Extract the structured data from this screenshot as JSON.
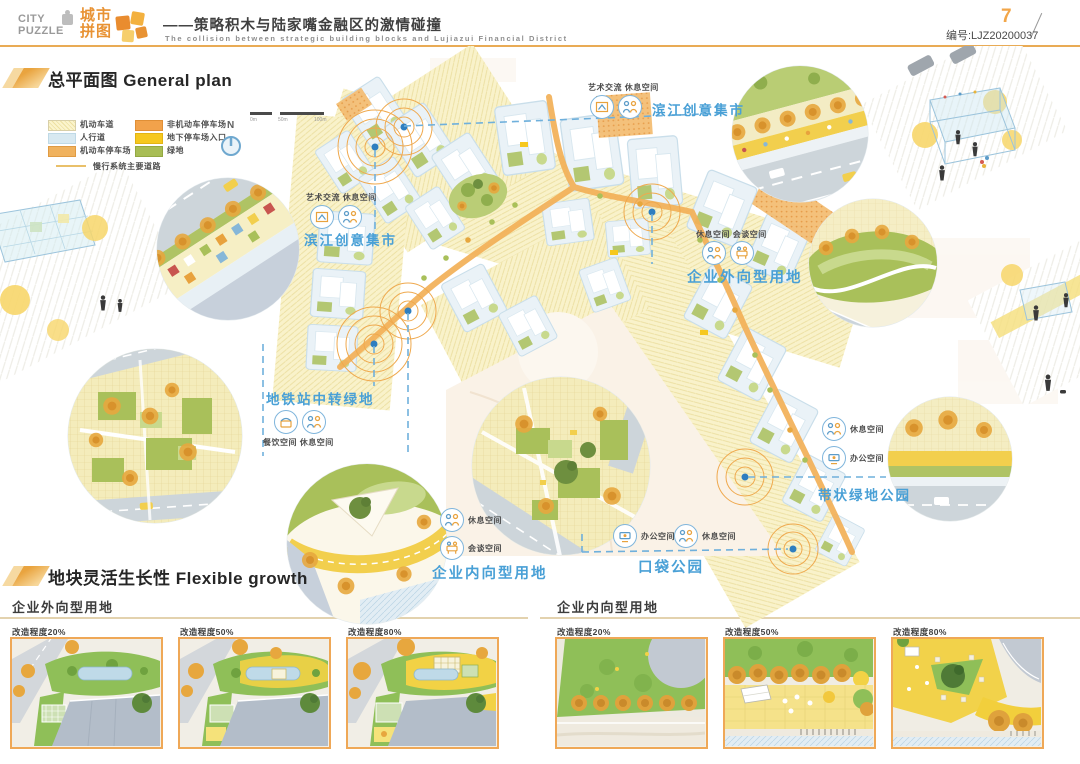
{
  "header": {
    "logo_en_top": "CITY",
    "logo_en_bottom": "PUZZLE",
    "logo_cn_top": "城市",
    "logo_cn_bottom": "拼图",
    "title_cn": "——策略积木与陆家嘴金融区的激情碰撞",
    "title_en": "The collision between strategic building blocks and Lujiazui Financial District",
    "page_number": "7",
    "doc_code": "编号:LJZ20200037"
  },
  "sections": {
    "plan_title": "总平面图 General plan",
    "growth_title": "地块灵活生长性 Flexible growth"
  },
  "legend": {
    "items": [
      {
        "label": "机动车道",
        "swatch": "#FBF4CD"
      },
      {
        "label": "人行道",
        "swatch": "#D8E9F1"
      },
      {
        "label": "机动车停车场",
        "swatch": "#F0B25E"
      },
      {
        "label": "非机动车停车场",
        "swatch": "#F2A24B"
      },
      {
        "label": "地下停车场入口",
        "swatch": "#F6C81E"
      },
      {
        "label": "绿地",
        "swatch": "#A8BD55"
      }
    ],
    "line_item": "慢行系统主要道路"
  },
  "compass_label": "N",
  "scalebar": {
    "labels": [
      "0m",
      "50m",
      "100m"
    ]
  },
  "callouts": {
    "riverside_market_top": {
      "small": "艺术交流 休息空间",
      "main": "滨江创意集市"
    },
    "riverside_market_left": {
      "small": "艺术交流 休息空间",
      "main": "滨江创意集市"
    },
    "enterprise_outward": {
      "small": "休息空间 会谈空间",
      "main": "企业外向型用地"
    },
    "metro_green": {
      "main": "地铁站中转绿地",
      "small": "餐饮空间 休息空间"
    },
    "belt_park": {
      "item1": "休息空间",
      "item2": "办公空间",
      "main": "带状绿地公园"
    },
    "enterprise_inward": {
      "item1": "休息空间",
      "item2": "会谈空间",
      "main": "企业内向型用地"
    },
    "pocket_park": {
      "item1": "办公空间",
      "item2": "休息空间",
      "main": "口袋公园"
    }
  },
  "growth": {
    "left_heading": "企业外向型用地",
    "right_heading": "企业内向型用地",
    "captions": [
      "改造程度20%",
      "改造程度50%",
      "改造程度80%"
    ]
  },
  "colors": {
    "accent_orange": "#EFA64F",
    "label_blue": "#49A0D6",
    "header_rule": "#E9AB55",
    "green": "#A8BD55"
  }
}
